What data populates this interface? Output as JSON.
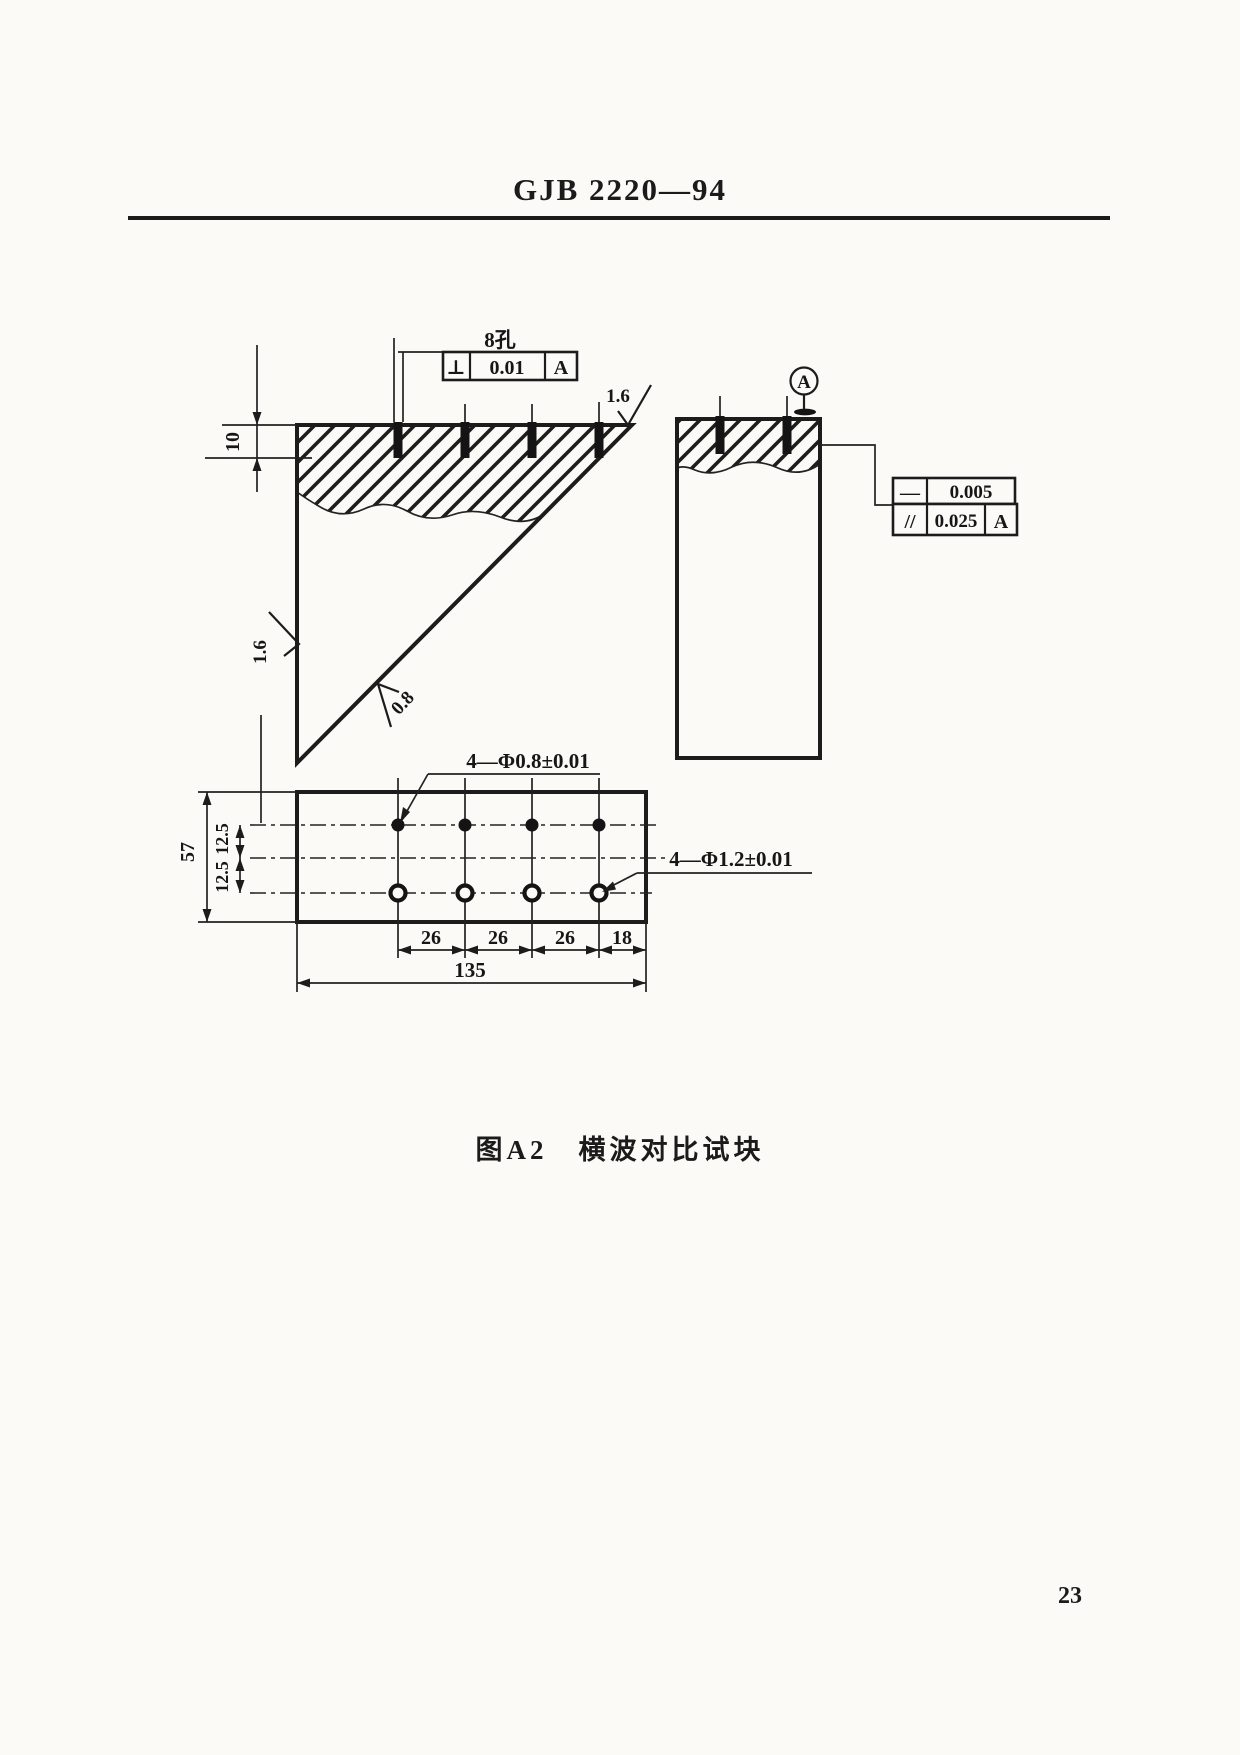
{
  "page": {
    "header_title": "GJB 2220—94",
    "caption": "图A2　横波对比试块",
    "page_number": "23"
  },
  "drawing": {
    "holes_label": "8孔",
    "fcf_perpendicularity": {
      "symbol": "⊥",
      "tolerance": "0.01",
      "datum": "A"
    },
    "fcf_straightness": {
      "symbol": "—",
      "tolerance": "0.005"
    },
    "fcf_parallelism": {
      "symbol": "//",
      "tolerance": "0.025",
      "datum": "A"
    },
    "datum_label": "A",
    "surface_roughness": {
      "top_face": "1.6",
      "left_face": "1.6",
      "inclined_face": "0.8"
    },
    "hole_callouts": {
      "small": "4—Φ0.8±0.01",
      "large": "4—Φ1.2±0.01"
    },
    "dimensions": {
      "hole_depth": "10",
      "plate_height": "57",
      "row_offset_top": "12.5",
      "row_offset_bottom": "12.5",
      "hole_spacings": [
        "26",
        "26",
        "26",
        "18"
      ],
      "plate_width": "135"
    }
  }
}
